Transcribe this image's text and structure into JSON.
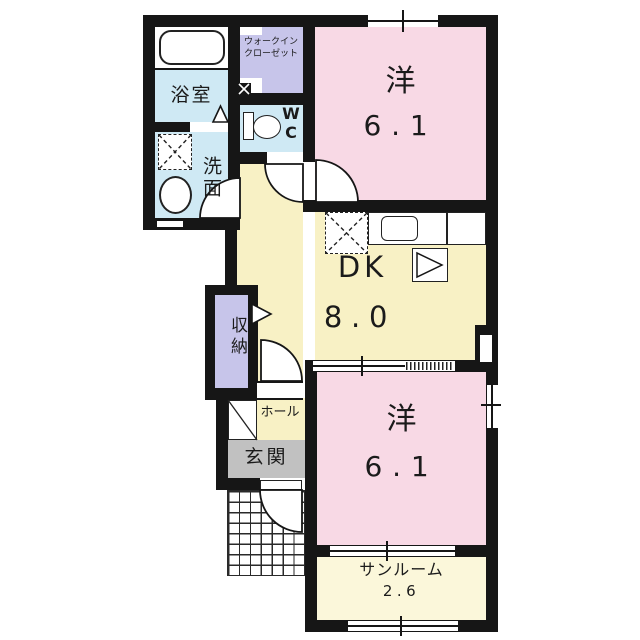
{
  "floorplan": {
    "rooms": {
      "bathroom": {
        "label": "浴室"
      },
      "walkin_closet": {
        "label_line1": "ウォークイン",
        "label_line2": "クローゼット"
      },
      "wc": {
        "label_line1": "W",
        "label_line2": "C"
      },
      "washroom": {
        "label": "洗面"
      },
      "bedroom_top": {
        "label": "洋",
        "size": "6.1"
      },
      "dining_kitchen": {
        "label": "DK",
        "size": "8.0"
      },
      "storage": {
        "label": "収納"
      },
      "hall": {
        "label": "ホール"
      },
      "entrance": {
        "label": "玄関"
      },
      "bedroom_bottom": {
        "label": "洋",
        "size": "6.1"
      },
      "sunroom": {
        "label": "サンルーム",
        "size": "2.6"
      }
    },
    "colors": {
      "wall": "#161616",
      "bedroom_pink": "#f8d9e5",
      "dk_yellow": "#f8f1c5",
      "sunroom_yellow": "#fbf7da",
      "water_blue": "#cfe9f4",
      "closet_lavender": "#c7c5ea",
      "entrance_gray": "#c1c1c1",
      "floor_white": "#ffffff"
    }
  }
}
